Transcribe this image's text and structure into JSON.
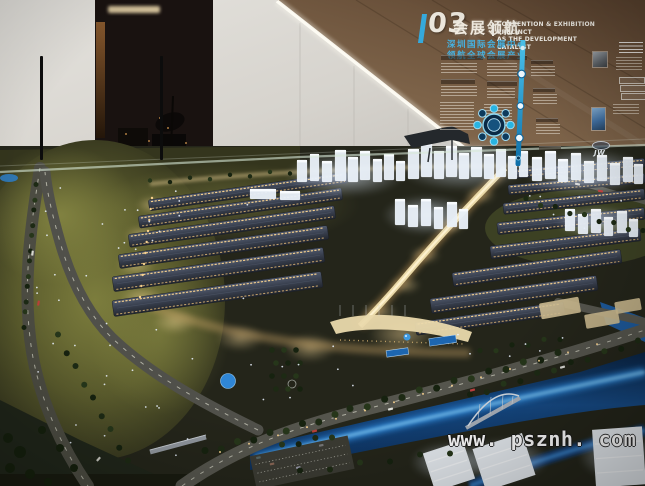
{
  "wall_panel": {
    "section_number": "03",
    "title_zh": "会展领航",
    "title_en": [
      "CONVENTION & EXHIBITION PRECINCT",
      "AS THE DEVELOPMENT CATALYST"
    ],
    "subtitle_zh": [
      "深圳国际会展中心",
      "领航全球会展产业"
    ],
    "logo_text": "JW",
    "accent_blue": "#35a9dc",
    "wall_color": "#7f644a"
  },
  "watermark": {
    "text": "www. psznh. com",
    "color": "#ffffff"
  },
  "scene_colors": {
    "hall_roof": "#3a4150",
    "edge_lights": "#ffd791",
    "lawn": "#5b5c2d",
    "water_glow": "#2f86d6",
    "towers": "#e9f0f8",
    "central_spine": "#f0dfae"
  }
}
